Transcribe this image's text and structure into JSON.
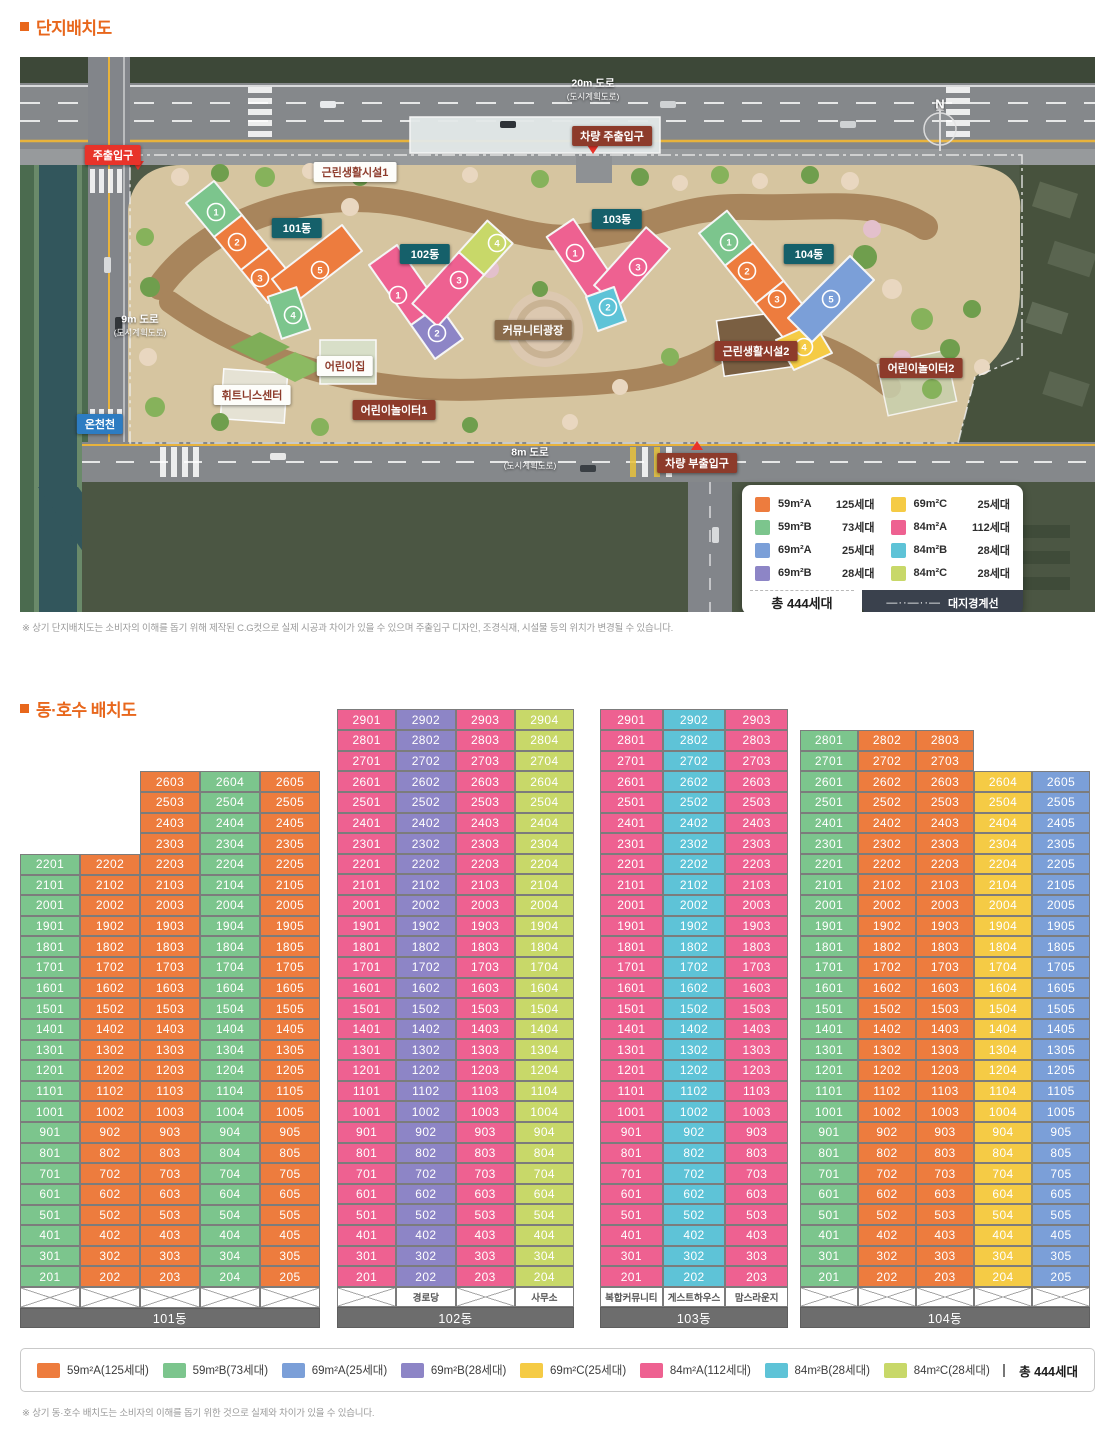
{
  "page": {
    "section1_title": "단지배치도",
    "section2_title": "동·호수 배치도",
    "footnote1": "※ 상기 단지배치도는 소비자의 이해를 돕기 위해 제작된 C.G컷으로 실제 시공과 차이가 있을 수 있으며 주출입구 디자인, 조경식재, 시설물 등의 위치가 변경될 수 있습니다.",
    "footnote2": "※ 상기 동·호수 배치도는 소비자의 이해를 돕기 위한 것으로 실제와 차이가 있을 수 있습니다."
  },
  "colors": {
    "accent": "#e8671c",
    "grid_border": "#7c7c7c",
    "name_bar": "#6d6d6d"
  },
  "types": {
    "59A": {
      "label": "59m²A",
      "households": 125,
      "color": "#ed7c3e"
    },
    "59B": {
      "label": "59m²B",
      "households": 73,
      "color": "#7cc58d"
    },
    "69A": {
      "label": "69m²A",
      "households": 25,
      "color": "#7b9fd8"
    },
    "69B": {
      "label": "69m²B",
      "households": 28,
      "color": "#8d85c6"
    },
    "69C": {
      "label": "69m²C",
      "households": 25,
      "color": "#f5cb45"
    },
    "84A": {
      "label": "84m²A",
      "households": 112,
      "color": "#ee6191"
    },
    "84B": {
      "label": "84m²B",
      "households": 28,
      "color": "#5ec3d7"
    },
    "84C": {
      "label": "84m²C",
      "households": 28,
      "color": "#c8d869"
    }
  },
  "site_plan": {
    "labels": {
      "main_gate": "주출입구",
      "vehicle_main": "차량 주출입구",
      "vehicle_sub": "차량 부출입구",
      "nbh1": "근린생활시설1",
      "nbh2": "근린생활시설2",
      "plaza": "커뮤니티광장",
      "daycare": "어린이집",
      "fitness": "휘트니스센터",
      "playground1": "어린이놀이터1",
      "playground2": "어린이놀이터2",
      "stream": "온천천",
      "compass": "N"
    },
    "roads": {
      "r20": "20m 도로",
      "r20s": "(도시계획도로)",
      "r9": "9m 도로",
      "r9s": "(도시계획도로)",
      "r8": "8m 도로",
      "r8s": "(도시계획도로)"
    },
    "buildings": [
      {
        "name": "101동",
        "units": [
          {
            "no": 1,
            "type": "59B"
          },
          {
            "no": 2,
            "type": "59A"
          },
          {
            "no": 3,
            "type": "59A"
          },
          {
            "no": 4,
            "type": "59B"
          },
          {
            "no": 5,
            "type": "59A"
          }
        ]
      },
      {
        "name": "102동",
        "units": [
          {
            "no": 1,
            "type": "84A"
          },
          {
            "no": 2,
            "type": "69B"
          },
          {
            "no": 3,
            "type": "84A"
          },
          {
            "no": 4,
            "type": "84C"
          }
        ]
      },
      {
        "name": "103동",
        "units": [
          {
            "no": 1,
            "type": "84A"
          },
          {
            "no": 2,
            "type": "84B"
          },
          {
            "no": 3,
            "type": "84A"
          }
        ]
      },
      {
        "name": "104동",
        "units": [
          {
            "no": 1,
            "type": "59B"
          },
          {
            "no": 2,
            "type": "59A"
          },
          {
            "no": 3,
            "type": "59A"
          },
          {
            "no": 4,
            "type": "69C"
          },
          {
            "no": 5,
            "type": "69A"
          }
        ]
      }
    ],
    "legend": {
      "items": [
        {
          "type": "59A",
          "label": "59m²A",
          "count": "125세대"
        },
        {
          "type": "59B",
          "label": "59m²B",
          "count": "73세대"
        },
        {
          "type": "69A",
          "label": "69m²A",
          "count": "25세대"
        },
        {
          "type": "69B",
          "label": "69m²B",
          "count": "28세대"
        },
        {
          "type": "69C",
          "label": "69m²C",
          "count": "25세대"
        },
        {
          "type": "84A",
          "label": "84m²A",
          "count": "112세대"
        },
        {
          "type": "84B",
          "label": "84m²B",
          "count": "28세대"
        },
        {
          "type": "84C",
          "label": "84m²C",
          "count": "28세대"
        }
      ],
      "total_label": "총 444세대",
      "boundary_label": "대지경계선",
      "boundary_dash": "—··—··—"
    }
  },
  "grid": {
    "bottom_floor": 2,
    "cell_format": "floor*100+unit",
    "buildings": [
      {
        "name": "101동",
        "columns": [
          {
            "unit": 1,
            "type": "59B",
            "top_floor": 22
          },
          {
            "unit": 2,
            "type": "59A",
            "top_floor": 22
          },
          {
            "unit": 3,
            "type": "59A",
            "top_floor": 26
          },
          {
            "unit": 4,
            "type": "59B",
            "top_floor": 26
          },
          {
            "unit": 5,
            "type": "59A",
            "top_floor": 26
          }
        ],
        "ground": [
          "x",
          "x",
          "x",
          "x",
          "x"
        ]
      },
      {
        "name": "102동",
        "columns": [
          {
            "unit": 1,
            "type": "84A",
            "top_floor": 29
          },
          {
            "unit": 2,
            "type": "69B",
            "top_floor": 29
          },
          {
            "unit": 3,
            "type": "84A",
            "top_floor": 29
          },
          {
            "unit": 4,
            "type": "84C",
            "top_floor": 29
          }
        ],
        "ground": [
          "x",
          "경로당",
          "x",
          "사무소"
        ]
      },
      {
        "name": "103동",
        "columns": [
          {
            "unit": 1,
            "type": "84A",
            "top_floor": 29
          },
          {
            "unit": 2,
            "type": "84B",
            "top_floor": 29
          },
          {
            "unit": 3,
            "type": "84A",
            "top_floor": 29
          }
        ],
        "ground": [
          "복합커뮤니티",
          "게스트하우스",
          "맘스라운지"
        ]
      },
      {
        "name": "104동",
        "columns": [
          {
            "unit": 1,
            "type": "59B",
            "top_floor": 28
          },
          {
            "unit": 2,
            "type": "59A",
            "top_floor": 28
          },
          {
            "unit": 3,
            "type": "59A",
            "top_floor": 28
          },
          {
            "unit": 4,
            "type": "69C",
            "top_floor": 26
          },
          {
            "unit": 5,
            "type": "69A",
            "top_floor": 26
          }
        ],
        "ground": [
          "x",
          "x",
          "x",
          "x",
          "x"
        ]
      }
    ]
  },
  "bottom_legend": {
    "items": [
      {
        "type": "59A",
        "label": "59m²A(125세대)"
      },
      {
        "type": "59B",
        "label": "59m²B(73세대)"
      },
      {
        "type": "69A",
        "label": "69m²A(25세대)"
      },
      {
        "type": "69B",
        "label": "69m²B(28세대)"
      },
      {
        "type": "69C",
        "label": "69m²C(25세대)"
      },
      {
        "type": "84A",
        "label": "84m²A(112세대)"
      },
      {
        "type": "84B",
        "label": "84m²B(28세대)"
      },
      {
        "type": "84C",
        "label": "84m²C(28세대)"
      }
    ],
    "total": "총 444세대"
  }
}
